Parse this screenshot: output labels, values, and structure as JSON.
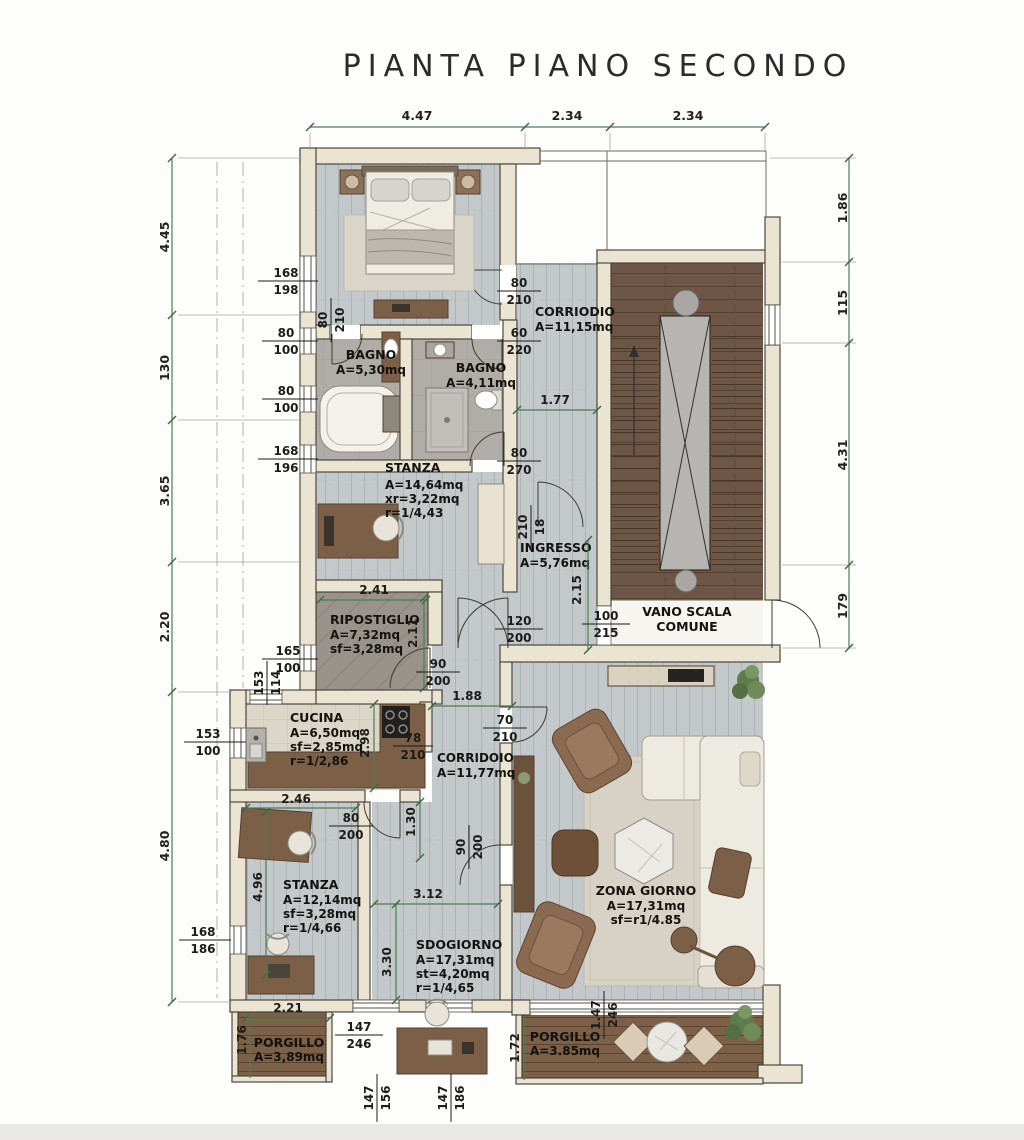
{
  "title": "PIANTA PIANO SECONDO",
  "palette": {
    "wall": "#ebe4d2",
    "wall_stroke": "#3f3a31",
    "floor_wood": "#c3c8cb",
    "floor_bath": "#b0ada8",
    "floor_stone": "#99938b",
    "floor_kitchen": "#dbd6c7",
    "stair_wood": "#6d5645",
    "deck_wood": "#7c6048",
    "dim_green": "#4e7c52",
    "text": "#1d1c18",
    "furniture_brown": "#7b5f46",
    "leather": "#8a6a50",
    "sofa": "#edeae1",
    "plant": "#5f7c4c"
  },
  "rooms": {
    "corridoio1": {
      "name": "CORRIODIO",
      "area": "A=11,15mq"
    },
    "bagno1": {
      "name": "BAGNO",
      "area": "A=5,30mq"
    },
    "bagno2": {
      "name": "BAGNO",
      "area": "A=4,11mq"
    },
    "stanza1": {
      "name": "STANZA",
      "area": "A=14,64mq",
      "sf": "xr=3,22mq",
      "r": "r=1/4,43"
    },
    "ingresso": {
      "name": "INGRESSO",
      "area": "A=5,76mq"
    },
    "ripostiglio": {
      "name": "RIPOSTIGLIO",
      "area": "A=7,32mq",
      "sf": "sf=3,28mq"
    },
    "vano_scala": {
      "name": "VANO SCALA",
      "name2": "COMUNE"
    },
    "cucina": {
      "name": "CUCINA",
      "area": "A=6,50mq",
      "sf": "sf=2,85mq",
      "r": "r=1/2,86"
    },
    "corridoio2": {
      "name": "CORRIDOIO",
      "area": "A=11,77mq"
    },
    "stanza2": {
      "name": "STANZA",
      "area": "A=12,14mq",
      "sf": "sf=3,28mq",
      "r": "r=1/4,66"
    },
    "soggiorno": {
      "name": "SDOGIORNO",
      "area": "A=17,31mq",
      "sf": "st=4,20mq",
      "r": "r=1/4,65"
    },
    "zona_giorno": {
      "name": "ZONA GIORNO",
      "area": "A=17,31mq",
      "sf": "sf=r1/4.85"
    },
    "porgillo1": {
      "name": "PORGILLO",
      "area": "A=3,89mq"
    },
    "porgillo2": {
      "name": "PORGILLO",
      "area": "A=3.85mq"
    }
  },
  "dims": {
    "top_1": "4.47",
    "top_2": "2.34",
    "top_3": "2.34",
    "left_1": "4.45",
    "left_2": "130",
    "left_3": "3.65",
    "left_4": "2.20",
    "left_5": "4.80",
    "right_1": "1.86",
    "right_2": "115",
    "right_3": "4.31",
    "right_4": "179",
    "corridor_w": "1.77",
    "rip_w": "2.41",
    "rip_h": "2.11",
    "ing_h": "2.15",
    "hall_w": "1.88",
    "cuc_h": "2.98",
    "cuc_w": "2.46",
    "cor2_h": "1.30",
    "sog_w": "3.12",
    "sog_h": "3.30",
    "st2_h": "4.96",
    "p1_w": "2.21",
    "p1_h": "1.76",
    "p2_h": "1.72"
  },
  "fr": {
    "win_bed": {
      "n": "168",
      "d": "198"
    },
    "door_bed": {
      "n": "80",
      "d": "210"
    },
    "win_b1a": {
      "n": "80",
      "d": "100"
    },
    "win_b1b": {
      "n": "80",
      "d": "100"
    },
    "win_st1": {
      "n": "168",
      "d": "196"
    },
    "door_cor": {
      "n": "80",
      "d": "210"
    },
    "door_b2": {
      "n": "60",
      "d": "220"
    },
    "door_st1": {
      "n": "80",
      "d": "270"
    },
    "niche_ing": {
      "n": "210",
      "d": "18"
    },
    "door_land": {
      "n": "100",
      "d": "215"
    },
    "door_entry": {
      "n": "120",
      "d": "200"
    },
    "door_rip": {
      "n": "90",
      "d": "200"
    },
    "win_rip": {
      "n": "165",
      "d": "100"
    },
    "win_step": {
      "n": "153",
      "d": "114"
    },
    "win_cuc": {
      "n": "153",
      "d": "100"
    },
    "door_cuc": {
      "n": "78",
      "d": "210"
    },
    "door_zg": {
      "n": "70",
      "d": "210"
    },
    "door_st2": {
      "n": "80",
      "d": "200"
    },
    "win_st2": {
      "n": "168",
      "d": "186"
    },
    "win_p1": {
      "n": "147",
      "d": "246"
    },
    "win_p2": {
      "n": "1.47",
      "d": "246"
    },
    "door_sog": {
      "n": "90",
      "d": "200"
    },
    "win_bot1": {
      "n": "147",
      "d": "156"
    },
    "win_bot2": {
      "n": "147",
      "d": "186"
    }
  }
}
